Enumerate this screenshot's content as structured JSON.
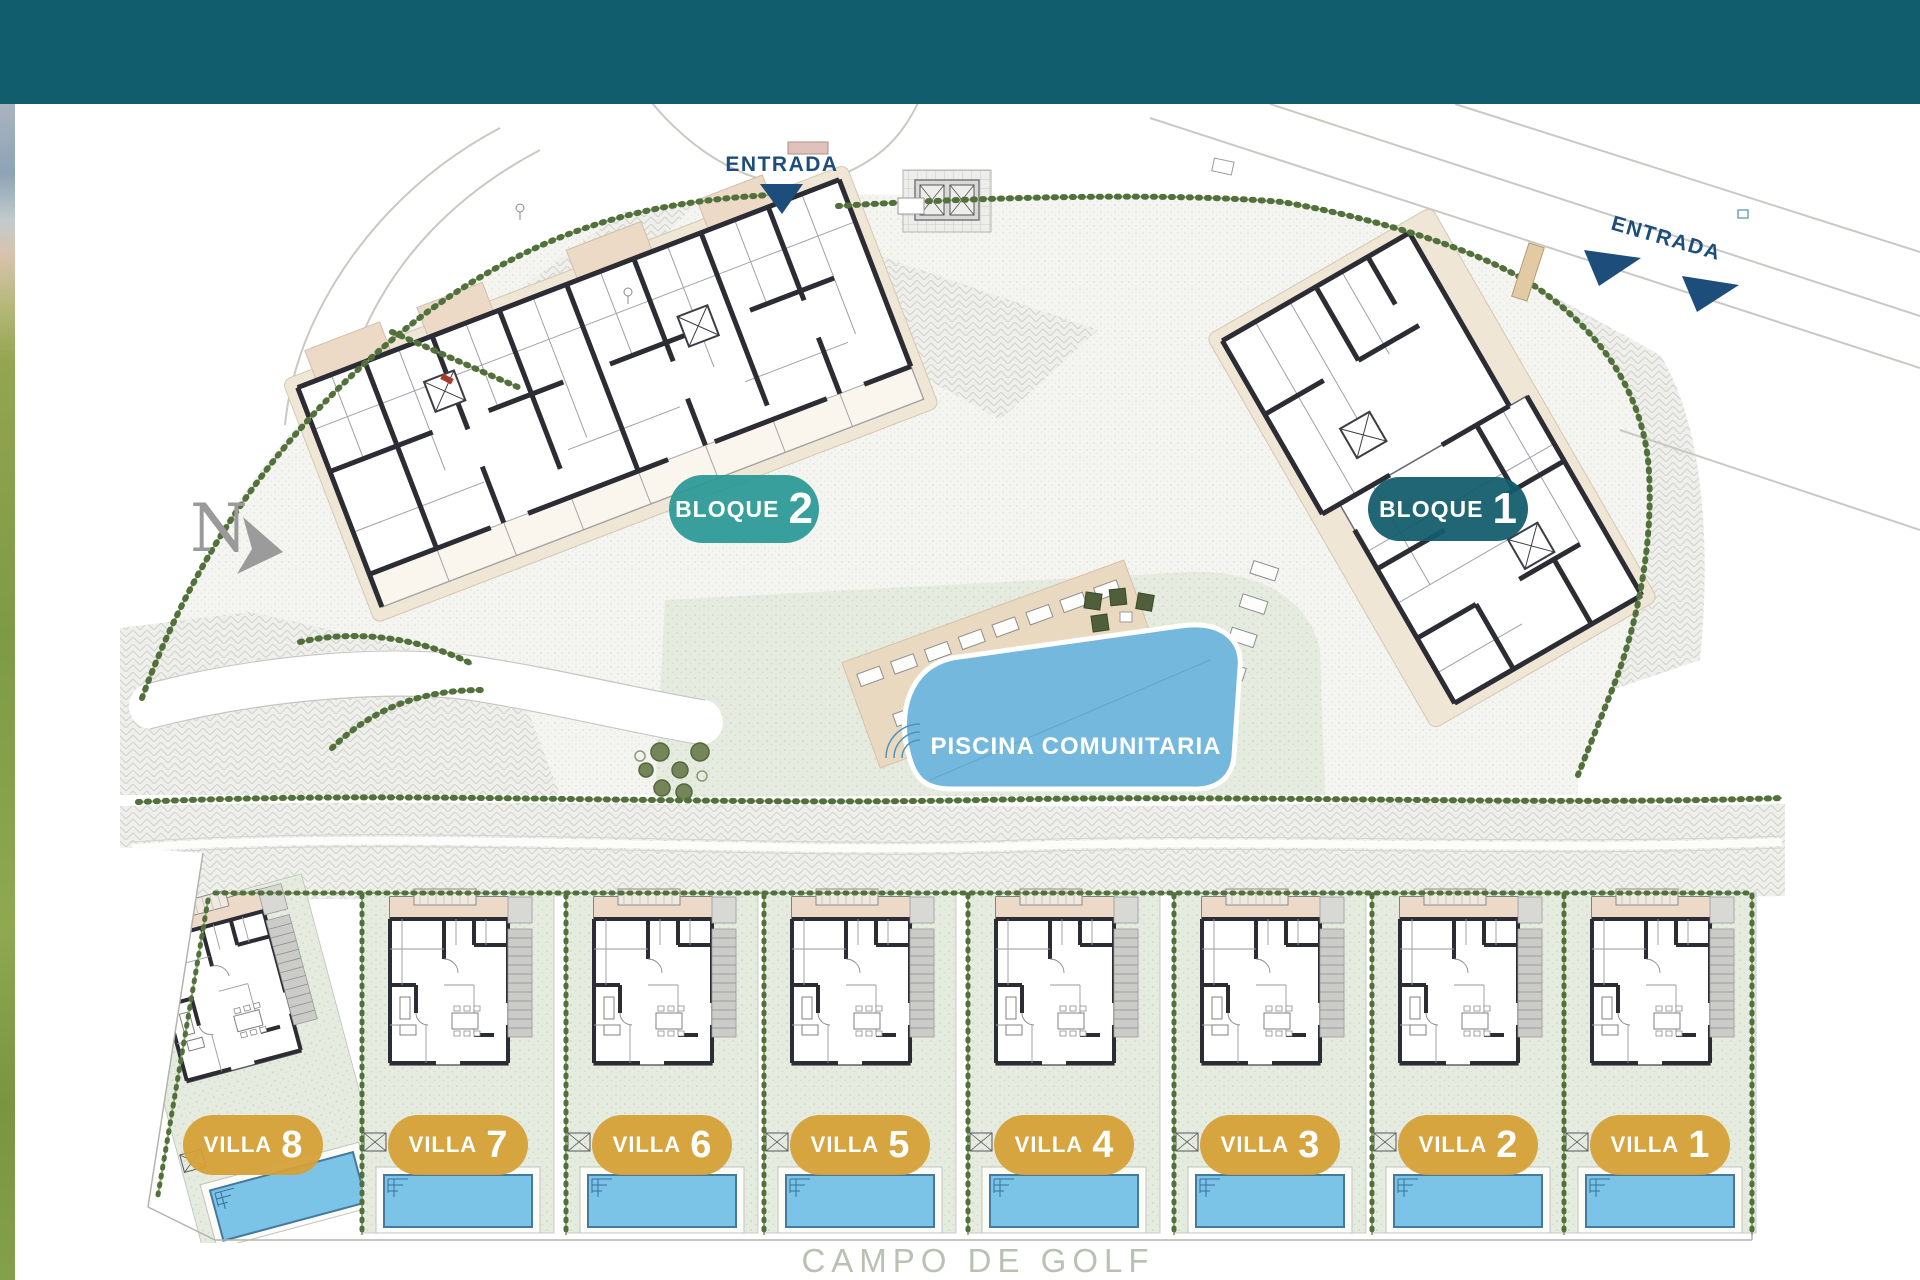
{
  "header": {
    "color": "#115C6D"
  },
  "north": {
    "label": "N"
  },
  "entrances": [
    {
      "label": "ENTRADA"
    },
    {
      "label": "ENTRADA"
    }
  ],
  "blocks": [
    {
      "label": "BLOQUE",
      "number": "1",
      "badge_color": "#135C6C"
    },
    {
      "label": "BLOQUE",
      "number": "2",
      "badge_color": "#299896"
    }
  ],
  "pool": {
    "label": "PISCINA COMUNITARIA",
    "water_color": "#74B8DE"
  },
  "villas": [
    {
      "label": "VILLA",
      "number": "8"
    },
    {
      "label": "VILLA",
      "number": "7"
    },
    {
      "label": "VILLA",
      "number": "6"
    },
    {
      "label": "VILLA",
      "number": "5"
    },
    {
      "label": "VILLA",
      "number": "4"
    },
    {
      "label": "VILLA",
      "number": "3"
    },
    {
      "label": "VILLA",
      "number": "2"
    },
    {
      "label": "VILLA",
      "number": "1"
    }
  ],
  "footer": {
    "label": "CAMPO DE GOLF"
  },
  "colors": {
    "villa_badge": "#D5A036",
    "villa_pool": "#7CC3E8",
    "hedge": "#52703C",
    "lawn": "#E5EBDF",
    "entrance_navy": "#1D4E7B",
    "road": "#EEEEEB",
    "wall": "#2C2C34",
    "golf_text": "#B9C1B3"
  }
}
